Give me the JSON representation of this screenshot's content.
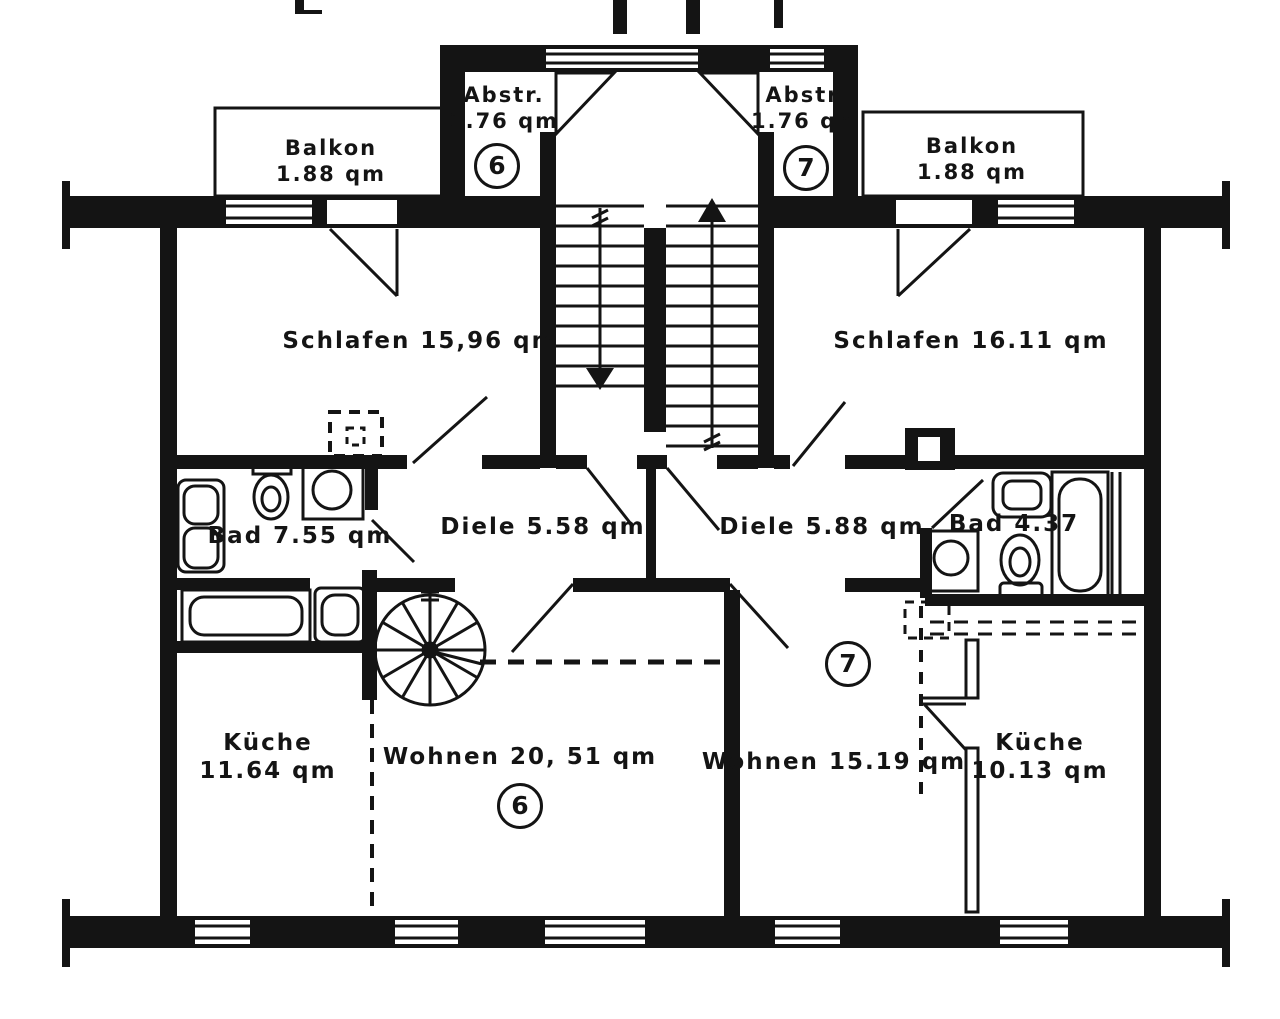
{
  "document": {
    "type": "apartment floor plan"
  },
  "apartments": {
    "left_number": "6",
    "right_number": "7"
  },
  "rooms": {
    "balkon_left": {
      "name": "Balkon",
      "area": "1.88 qm"
    },
    "abstell_left": {
      "name": "Abstr.",
      "area": "1.76 qm"
    },
    "abstell_right": {
      "name": "Abstr.",
      "area": "1.76 qm"
    },
    "balkon_right": {
      "name": "Balkon",
      "area": "1.88 qm"
    },
    "schlafen_left": {
      "label": "Schlafen 15,96 qm"
    },
    "schlafen_right": {
      "label": "Schlafen 16.11 qm"
    },
    "bad_left": {
      "label": "Bad 7.55 qm"
    },
    "diele_left": {
      "label": "Diele 5.58 qm"
    },
    "diele_right": {
      "label": "Diele 5.88 qm"
    },
    "bad_right": {
      "label": "Bad 4.37"
    },
    "kueche_left": {
      "name": "Küche",
      "area": "11.64 qm"
    },
    "wohnen_left": {
      "label": "Wohnen 20, 51 qm"
    },
    "wohnen_right": {
      "label": "Wohnen 15.19 qm"
    },
    "kueche_right": {
      "name": "Küche",
      "area": "10.13 qm"
    }
  }
}
